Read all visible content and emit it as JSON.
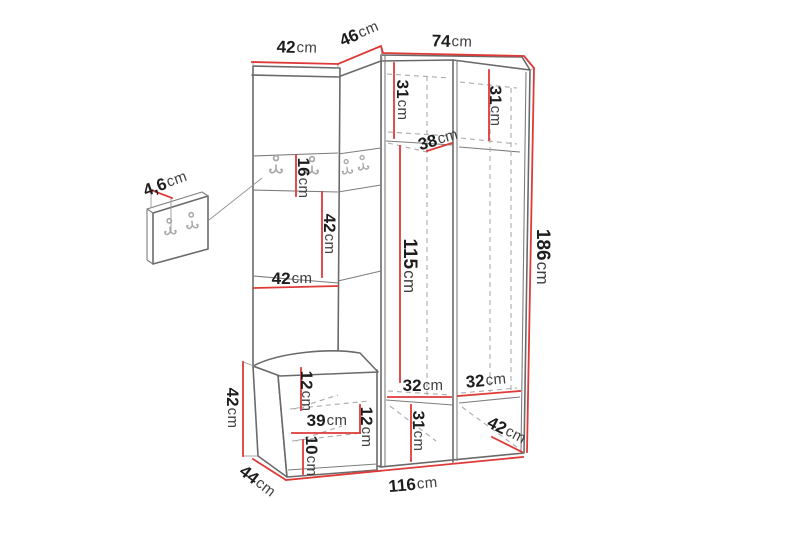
{
  "diagram": {
    "type": "furniture-dimension-diagram",
    "subject": "hallway wardrobe set with coat hooks, bench and wall hook panel",
    "unit": "cm"
  },
  "colors": {
    "background": "#ffffff",
    "dimension_line": "#de3a37",
    "outline": "#6a6a6a",
    "hidden_edge_dash": "#ababab",
    "value_text": "#1d1d1d",
    "unit_text": "#3f3f3f"
  },
  "dims": {
    "top_left": {
      "value": "42",
      "unit": "cm"
    },
    "top_corner": {
      "value": "46",
      "unit": "cm"
    },
    "top_right": {
      "value": "74",
      "unit": "cm"
    },
    "upper_comp_left": {
      "value": "31",
      "unit": "cm"
    },
    "upper_comp_right": {
      "value": "31",
      "unit": "cm"
    },
    "upper_shelf_depth": {
      "value": "38",
      "unit": "cm"
    },
    "hook_row_height": {
      "value": "16",
      "unit": "cm"
    },
    "open_height": {
      "value": "42",
      "unit": "cm"
    },
    "open_width": {
      "value": "42",
      "unit": "cm"
    },
    "panel_thickness": {
      "value": "4,6",
      "unit": "cm"
    },
    "door_height": {
      "value": "115",
      "unit": "cm"
    },
    "total_height": {
      "value": "186",
      "unit": "cm"
    },
    "bench_height": {
      "value": "42",
      "unit": "cm"
    },
    "bench_depth": {
      "value": "44",
      "unit": "cm"
    },
    "bench_top_gap": {
      "value": "12",
      "unit": "cm"
    },
    "bench_inner_width": {
      "value": "39",
      "unit": "cm"
    },
    "bench_side_gap": {
      "value": "12",
      "unit": "cm"
    },
    "bench_bottom_gap": {
      "value": "10",
      "unit": "cm"
    },
    "lower_inner_left": {
      "value": "32",
      "unit": "cm"
    },
    "lower_inner_right": {
      "value": "32",
      "unit": "cm"
    },
    "lower_comp_height": {
      "value": "31",
      "unit": "cm"
    },
    "unit_depth": {
      "value": "42",
      "unit": "cm"
    },
    "total_width": {
      "value": "116",
      "unit": "cm"
    }
  }
}
